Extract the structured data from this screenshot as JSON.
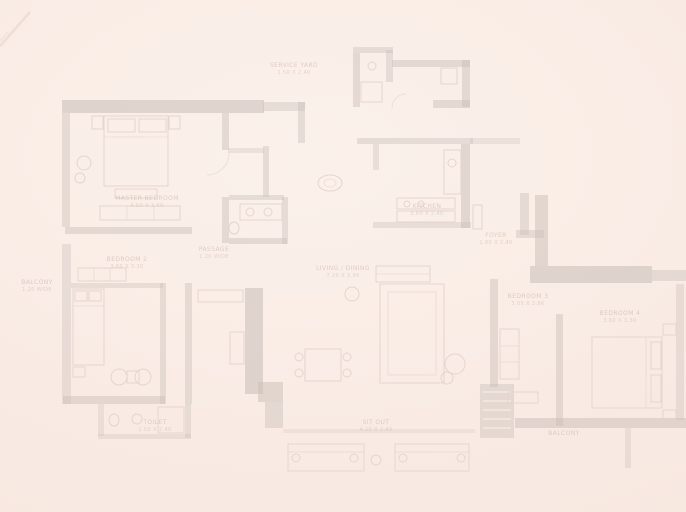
{
  "floorplan": {
    "colors": {
      "bg": "#f9ebe4",
      "wall": "#c9beb8",
      "furn": "#e2d3ca",
      "label": "#c9aea2"
    },
    "rooms": [
      {
        "key": "service-yard",
        "name": "SERVICE YARD",
        "dims": "1.50 X 2.40"
      },
      {
        "key": "kitchen",
        "name": "KITCHEN",
        "dims": "3.60 X 2.40"
      },
      {
        "key": "foyer",
        "name": "FOYER",
        "dims": "1.80 X 2.40"
      },
      {
        "key": "master-bedroom",
        "name": "MASTER BEDROOM",
        "dims": "4.50 X 3.60"
      },
      {
        "key": "passage",
        "name": "PASSAGE",
        "dims": "1.20 WIDE"
      },
      {
        "key": "balcony-left",
        "name": "BALCONY",
        "dims": "1.20 WIDE"
      },
      {
        "key": "bedroom-2",
        "name": "BEDROOM 2",
        "dims": "3.60 X 3.30"
      },
      {
        "key": "living-dining",
        "name": "LIVING / DINING",
        "dims": "7.20 X 3.90"
      },
      {
        "key": "bedroom-3",
        "name": "BEDROOM 3",
        "dims": "3.05 X 3.66"
      },
      {
        "key": "bedroom-4",
        "name": "BEDROOM 4",
        "dims": "3.60 X 3.30"
      },
      {
        "key": "toilet-2",
        "name": "TOILET",
        "dims": "1.50 X 2.40"
      },
      {
        "key": "balcony-right",
        "name": "BALCONY",
        "dims": ""
      },
      {
        "key": "sit-out",
        "name": "SIT OUT",
        "dims": "4.20 X 2.40"
      }
    ]
  }
}
